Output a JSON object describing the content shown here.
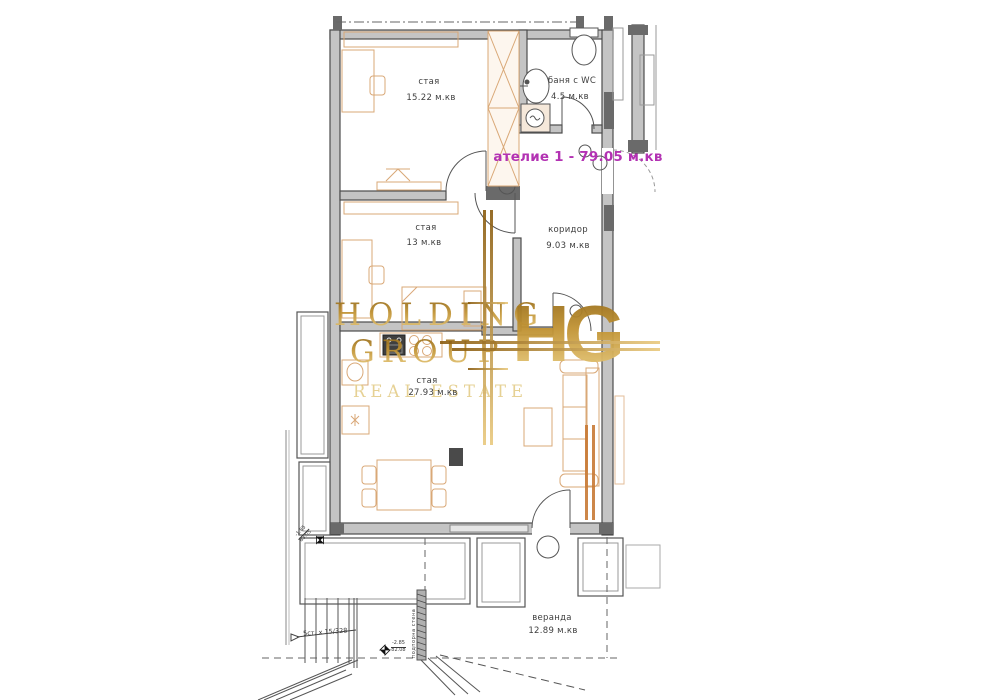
{
  "plan": {
    "unit_label": "ателие 1 - 79.05 м.кв",
    "rooms": [
      {
        "id": "room-top",
        "name": "стая",
        "area": "15.22 м.кв"
      },
      {
        "id": "bathroom",
        "name": "баня с WC",
        "area": "4.5 м.кв"
      },
      {
        "id": "corridor",
        "name": "коридор",
        "area": "9.03 м.кв"
      },
      {
        "id": "room-middle",
        "name": "стая",
        "area": "13 м.кв"
      },
      {
        "id": "living-room",
        "name": "стая",
        "area": "27.93 м.кв"
      },
      {
        "id": "veranda",
        "name": "веранда",
        "area": "12.89 м.кв"
      }
    ],
    "annotations": {
      "stairs": "5ст. х 15/328",
      "level_marker_1": {
        "top": "-1.85",
        "bottom": "83.05"
      },
      "level_marker_2": {
        "top": "-2.85",
        "bottom": "82.08"
      },
      "retaining_wall": "подпорна стена"
    }
  },
  "watermark": {
    "line1": "HOLDING",
    "line2": "GROUP",
    "line3": "REAL ESTATE",
    "monogram": "HG"
  },
  "colors": {
    "unit_label_purple": "#b332b3",
    "watermark_gold": "#c29434",
    "wall_gray": "#c4c4c4",
    "wall_edge": "#4c4c4c",
    "furniture_tan": "#d9a877",
    "background": "#ffffff"
  }
}
